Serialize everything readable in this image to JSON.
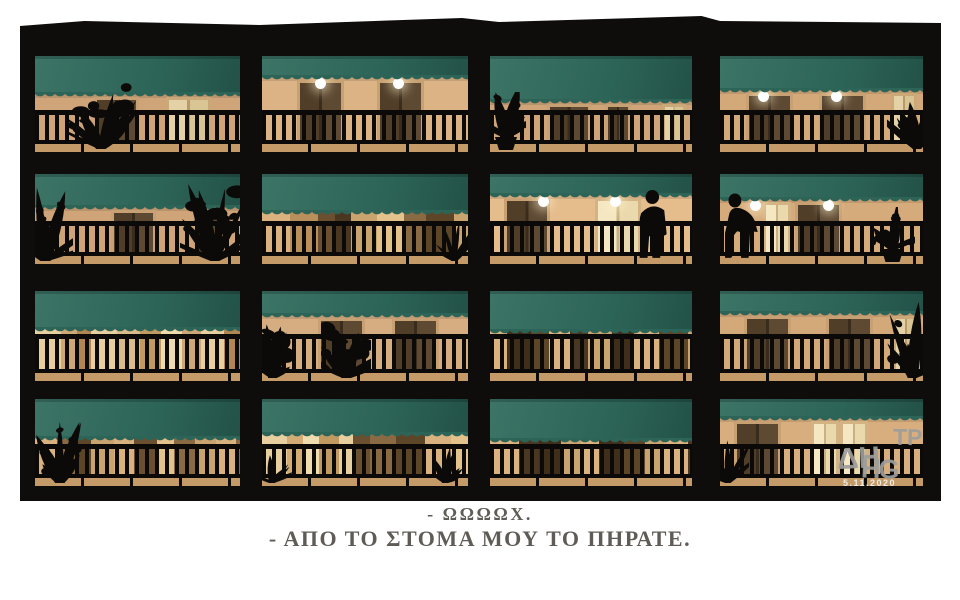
{
  "cartoon": {
    "caption": {
      "lines": [
        "- ΩΩΩΩΧ.",
        "- ΑΠΟ ΤΟ ΣΤΟΜΑ ΜΟΥ ΤΟ ΠΗΡΑΤΕ."
      ],
      "color": "#5f5b56"
    },
    "signature": {
      "parts": [
        "ΔΗ",
        "ΤΡ",
        "ΗG"
      ],
      "date": "5.11.2020",
      "color": "#9d9d9b",
      "date_color": "#efece4"
    },
    "palette": {
      "page_background": "#ffffff",
      "frame": "#0e0d0b",
      "silhouette": "#0b0a08",
      "awning": "#2d6458",
      "awning_light": "#3c7466",
      "awning_dark": "#235247",
      "light": "#ffffff",
      "light_glow": "rgba(255,242,200,0.55)",
      "floor": "#c49a68",
      "door_types": {
        "dark": [
          "#513e29",
          "#5e4933",
          "#3a2c1c",
          "#c7a173"
        ],
        "light": [
          "#e4d2a6",
          "#d9c494",
          "#b89a6a",
          "#caa878"
        ],
        "lit": [
          "#f4e7c2",
          "#ead9ad",
          "#c9b183",
          "#d3b384"
        ]
      }
    },
    "building": {
      "rows": 4,
      "cols": 4,
      "cells": [
        {
          "row": 1,
          "col": 1,
          "awning_frac": 0.38,
          "wall": "plain",
          "wall_color": "#cfa478",
          "lights": [],
          "doors": [
            {
              "x": 0.29,
              "w": 0.19,
              "type": "dark"
            },
            {
              "x": 0.64,
              "w": 0.19,
              "type": "light"
            }
          ],
          "plants": [
            {
              "x": 0.32,
              "w": 70,
              "h": 80,
              "type": "bush"
            }
          ]
        },
        {
          "row": 1,
          "col": 2,
          "awning_frac": 0.2,
          "wall": "plain",
          "wall_color": "#dcb385",
          "lights": [
            0.28,
            0.66
          ],
          "doors": [
            {
              "x": 0.17,
              "w": 0.2,
              "type": "dark"
            },
            {
              "x": 0.56,
              "w": 0.2,
              "type": "dark"
            }
          ],
          "plants": []
        },
        {
          "row": 1,
          "col": 3,
          "awning_frac": 0.45,
          "wall": "plain",
          "wall_color": "#cfa478",
          "lights": [],
          "doors": [
            {
              "x": 0.28,
              "w": 0.19,
              "type": "dark"
            },
            {
              "x": 0.57,
              "w": 0.1,
              "type": "dark"
            },
            {
              "x": 0.85,
              "w": 0.09,
              "type": "light"
            }
          ],
          "plants": [
            {
              "x": 0.08,
              "w": 40,
              "h": 58,
              "type": "potted"
            }
          ]
        },
        {
          "row": 1,
          "col": 4,
          "awning_frac": 0.33,
          "wall": "plain",
          "wall_color": "#d4a97a",
          "lights": [
            0.21,
            0.57
          ],
          "doors": [
            {
              "x": 0.13,
              "w": 0.2,
              "type": "dark"
            },
            {
              "x": 0.49,
              "w": 0.2,
              "type": "dark"
            },
            {
              "x": 0.84,
              "w": 0.1,
              "type": "light"
            }
          ],
          "plants": [
            {
              "x": 0.97,
              "w": 60,
              "h": 75,
              "type": "palm"
            }
          ]
        },
        {
          "row": 2,
          "col": 1,
          "awning_frac": 0.35,
          "wall": "plain",
          "wall_color": "#cfa478",
          "lights": [],
          "doors": [
            {
              "x": 0.37,
              "w": 0.19,
              "type": "dark"
            },
            {
              "x": 0.77,
              "w": 0.11,
              "type": "dark"
            }
          ],
          "plants": [
            {
              "x": 0.05,
              "w": 55,
              "h": 88,
              "type": "palm"
            },
            {
              "x": 0.88,
              "w": 70,
              "h": 92,
              "type": "bush"
            }
          ]
        },
        {
          "row": 2,
          "col": 2,
          "awning_frac": 0.4,
          "wall": "shutters",
          "stripes": [
            "#d9b27f",
            "#b98f5c",
            "#6b4f31",
            "#4a3722",
            "#caa46f",
            "#e3c28c",
            "#8a6a43",
            "#5d4528",
            "#caa46f",
            "#e3c28c",
            "#b98f5c",
            "#d9b27f"
          ],
          "plants": [
            {
              "x": 0.93,
              "w": 50,
              "h": 52,
              "type": "spiky"
            }
          ]
        },
        {
          "row": 2,
          "col": 3,
          "awning_frac": 0.21,
          "wall": "plain",
          "wall_color": "#e5bc8c",
          "lights": [
            0.26,
            0.62
          ],
          "doors": [
            {
              "x": 0.07,
              "w": 0.2,
              "type": "dark"
            },
            {
              "x": 0.52,
              "w": 0.2,
              "type": "lit"
            }
          ],
          "people": [
            {
              "x": 0.8,
              "pose": "stand"
            }
          ]
        },
        {
          "row": 2,
          "col": 4,
          "awning_frac": 0.26,
          "wall": "plain",
          "wall_color": "#d6ab7c",
          "lights": [
            0.17,
            0.53
          ],
          "doors": [
            {
              "x": 0.21,
              "w": 0.11,
              "type": "lit"
            },
            {
              "x": 0.37,
              "w": 0.2,
              "type": "dark"
            }
          ],
          "people": [
            {
              "x": 0.11,
              "pose": "lean"
            }
          ],
          "plants": [
            {
              "x": 0.85,
              "w": 45,
              "h": 55,
              "type": "potted"
            }
          ]
        },
        {
          "row": 3,
          "col": 1,
          "awning_frac": 0.4,
          "wall": "shutters",
          "stripes": [
            "#e8cfa0",
            "#cda876",
            "#b28653",
            "#e8cfa0",
            "#d9bc8a",
            "#c19a62",
            "#efdcae",
            "#cda876",
            "#e8cfa0",
            "#b28653"
          ],
          "plants": []
        },
        {
          "row": 3,
          "col": 2,
          "awning_frac": 0.24,
          "wall": "plain",
          "wall_color": "#d6ad80",
          "lights": [],
          "doors": [
            {
              "x": 0.27,
              "w": 0.2,
              "type": "dark"
            },
            {
              "x": 0.63,
              "w": 0.2,
              "type": "dark"
            }
          ],
          "plants": [
            {
              "x": 0.05,
              "w": 45,
              "h": 58,
              "type": "bush"
            },
            {
              "x": 0.41,
              "w": 50,
              "h": 62,
              "type": "bush"
            }
          ]
        },
        {
          "row": 3,
          "col": 3,
          "awning_frac": 0.42,
          "wall": "shutters",
          "stripes": [
            "#d9b27f",
            "#3f2f1a",
            "#5d4528",
            "#d9b27f",
            "#4a3722",
            "#caa46f",
            "#3f2f1a",
            "#d9b27f",
            "#5d4528",
            "#caa46f"
          ],
          "plants": []
        },
        {
          "row": 3,
          "col": 4,
          "awning_frac": 0.22,
          "wall": "plain",
          "wall_color": "#d4a97a",
          "lights": [],
          "doors": [
            {
              "x": 0.12,
              "w": 0.2,
              "type": "dark"
            },
            {
              "x": 0.52,
              "w": 0.2,
              "type": "dark"
            },
            {
              "x": 0.85,
              "w": 0.1,
              "type": "light"
            }
          ],
          "plants": [
            {
              "x": 0.95,
              "w": 55,
              "h": 85,
              "type": "palm"
            }
          ]
        },
        {
          "row": 4,
          "col": 1,
          "awning_frac": 0.42,
          "wall": "shutters",
          "stripes": [
            "#d9b27f",
            "#8a6a43",
            "#5d4528",
            "#caa46f",
            "#d9b27f",
            "#6b4f31",
            "#e3c28c",
            "#8a6a43",
            "#caa46f"
          ],
          "plants": [
            {
              "x": 0.12,
              "w": 50,
              "h": 72,
              "type": "palm"
            }
          ]
        },
        {
          "row": 4,
          "col": 2,
          "awning_frac": 0.38,
          "wall": "shutters",
          "stripes": [
            "#e8cfa0",
            "#d2ac74",
            "#f0dcae",
            "#c19a62",
            "#e8cfa0",
            "#6b4f31",
            "#8a6a43",
            "#5d4528",
            "#d9b27f",
            "#e3c28c"
          ],
          "plants": [
            {
              "x": 0.05,
              "w": 42,
              "h": 36,
              "type": "spiky"
            },
            {
              "x": 0.89,
              "w": 48,
              "h": 40,
              "type": "spiky"
            }
          ]
        },
        {
          "row": 4,
          "col": 3,
          "awning_frac": 0.45,
          "wall": "shutters",
          "stripes": [
            "#d9b27f",
            "#4a3722",
            "#3f2f1a",
            "#caa46f",
            "#d9b27f",
            "#3f2f1a",
            "#5d4528",
            "#caa46f",
            "#d9b27f",
            "#4a3722"
          ],
          "plants": []
        },
        {
          "row": 4,
          "col": 4,
          "awning_frac": 0.2,
          "wall": "plain",
          "wall_color": "#d9ae7e",
          "lights": [],
          "doors": [
            {
              "x": 0.07,
              "w": 0.2,
              "type": "dark"
            },
            {
              "x": 0.45,
              "w": 0.11,
              "type": "lit"
            },
            {
              "x": 0.59,
              "w": 0.11,
              "type": "lit"
            }
          ],
          "plants": [
            {
              "x": 0.04,
              "w": 42,
              "h": 55,
              "type": "spiky"
            }
          ]
        }
      ]
    }
  }
}
